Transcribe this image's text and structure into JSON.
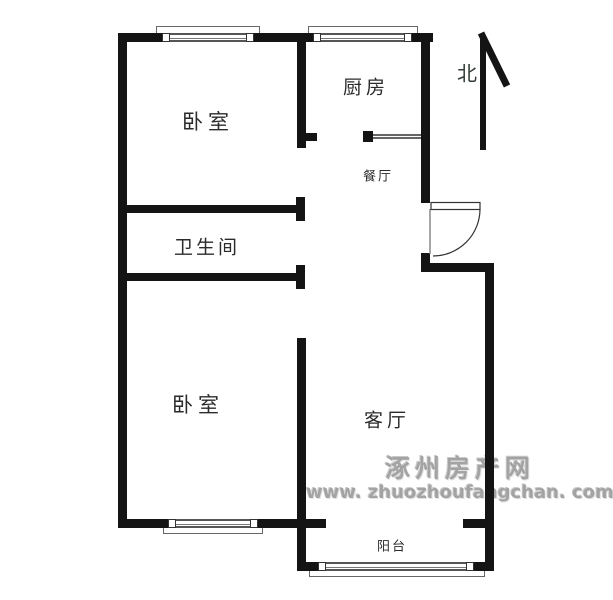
{
  "plan": {
    "title": "apartment-floor-plan",
    "rooms": [
      {
        "id": "bedroom-top",
        "label": "卧室"
      },
      {
        "id": "kitchen",
        "label": "厨房"
      },
      {
        "id": "dining",
        "label": "餐厅"
      },
      {
        "id": "bathroom",
        "label": "卫生间"
      },
      {
        "id": "bedroom-bottom",
        "label": "卧室"
      },
      {
        "id": "living-room",
        "label": "客厅"
      },
      {
        "id": "balcony",
        "label": "阳台"
      }
    ],
    "north_label": "北"
  },
  "watermark": {
    "site_name": "涿州房产网",
    "site_url": "www. zhuozhoufangchan. com"
  },
  "colors": {
    "wall": "#141414",
    "window_line": "#666666",
    "watermark_gray": "#a3a3a3",
    "background": "#ffffff"
  }
}
